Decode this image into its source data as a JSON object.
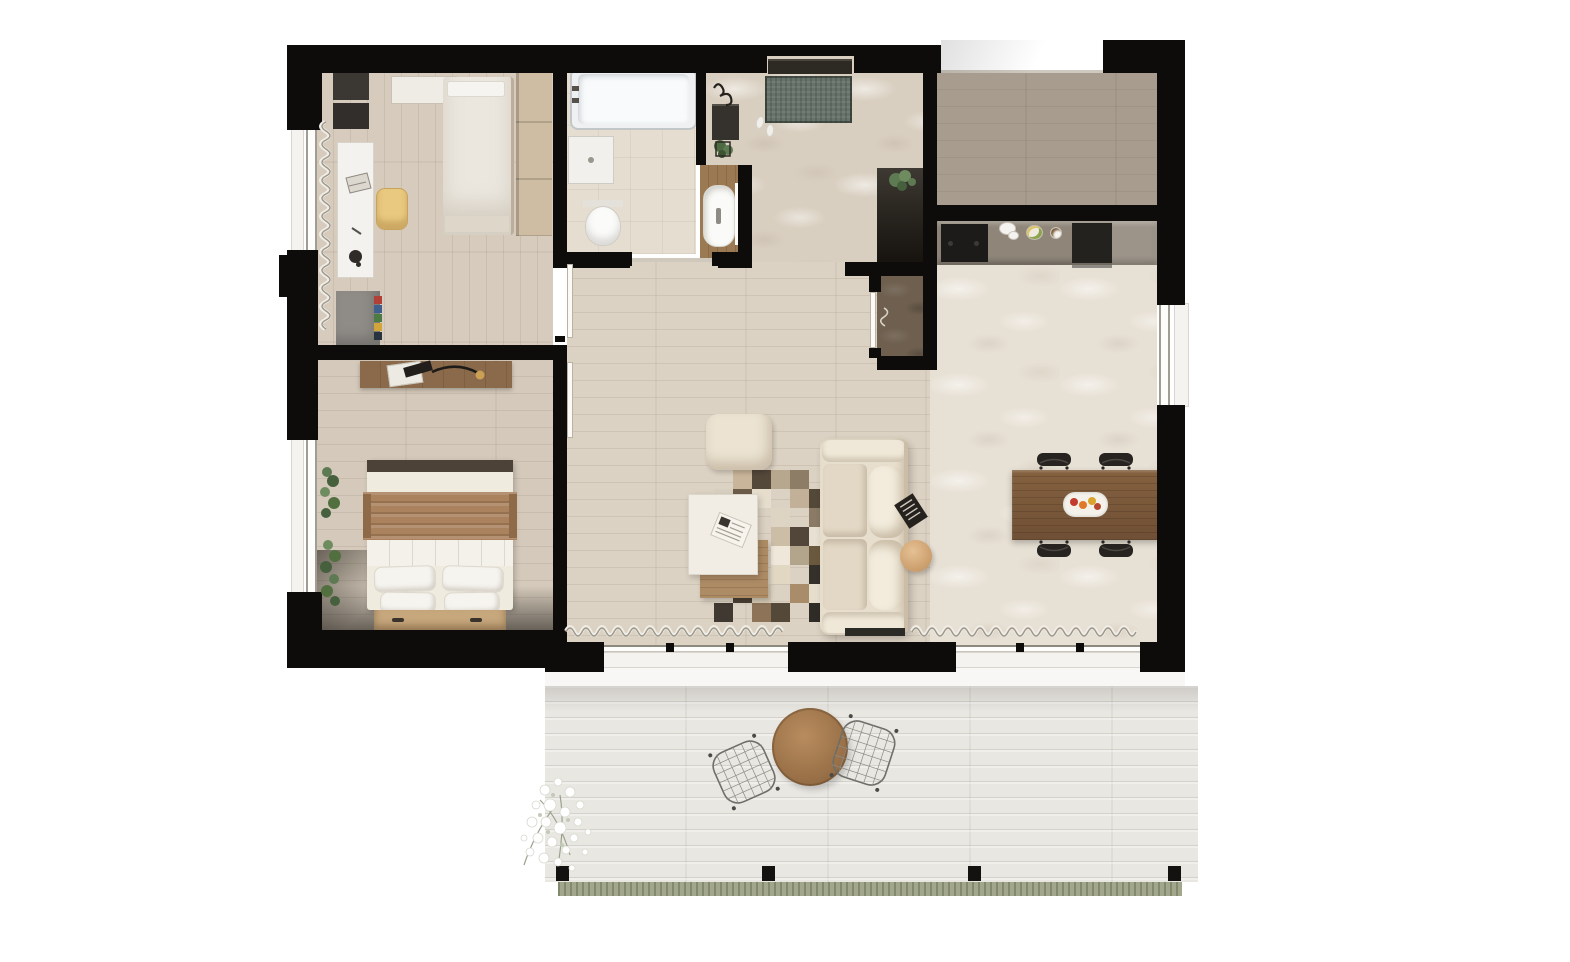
{
  "meta": {
    "title": "Apartment floor plan - photorealistic top-down render",
    "view": "top-down",
    "visible_text": "none (render contains no labels or dimensions)"
  },
  "palette": {
    "background": "#ffffff",
    "wall_black": "#0d0c0a",
    "office_floor": "#d6cbbc",
    "bedroom_floor": "#d4c9ba",
    "bathroom_floor": "#e5ded0",
    "hall_rug_beige": "#d9cfc0",
    "back_room_floor": "#a79c8e",
    "kitchen_counter": "#8f8679",
    "appliance_dark": "#1d1b19",
    "tall_cabinet_dark": "#2a2620",
    "living_floor": "#dcd2c3",
    "dining_rug_cream": "#e7e0d4",
    "sofa_cream": "#e7decd",
    "dining_table_wood": "#7e5c3f",
    "coffee_table_white": "#f2ede4",
    "coffee_table_shelf_wood": "#ad8b65",
    "terrace_deck": "#e9e7e2",
    "terrace_table_wood": "#a0764c",
    "doormat_green": "#67736a",
    "plant_green": "#5e7a52",
    "grass_green": "#a2a68c",
    "bed_throw_brown": "#aa825e",
    "desk_chair_yellow": "#e9c87f",
    "book_colors": [
      "#b04038",
      "#3f5f8f",
      "#4d7b45",
      "#d2a53b",
      "#27333f"
    ]
  },
  "rooms": [
    {
      "id": "office",
      "label": "Office / guest bedroom",
      "furniture": [
        "single bed",
        "wardrobe",
        "white desk",
        "yellow desk chair",
        "desk lamp",
        "laptop",
        "storage boxes",
        "wall tray shelf",
        "grey side table with colored books",
        "window curtain"
      ]
    },
    {
      "id": "bathroom",
      "label": "Bathroom",
      "furniture": [
        "bathtub with faucet",
        "shower tray",
        "wall-hung toilet",
        "wooden vanity with white basin"
      ]
    },
    {
      "id": "hall",
      "label": "Entry hall",
      "furniture": [
        "entry door",
        "green doormat",
        "slippers",
        "coat hooks",
        "dark console",
        "potted plant",
        "beige textured rug"
      ]
    },
    {
      "id": "backroom",
      "label": "Back room",
      "furniture": [
        "empty - dark wood plank floor"
      ]
    },
    {
      "id": "kitchen",
      "label": "Kitchen",
      "furniture": [
        "counter",
        "cooktop",
        "double sink",
        "fruit bowl",
        "coffee cup",
        "built-in oven",
        "tall dark cabinet with plant"
      ]
    },
    {
      "id": "closet",
      "label": "Storage closet",
      "furniture": [
        "door with handle",
        "stone floor"
      ]
    },
    {
      "id": "living",
      "label": "Living room",
      "furniture": [
        "cream sofa with back cushions",
        "book",
        "pouf",
        "white coffee table",
        "wood under-shelf",
        "magazine",
        "patchwork rug",
        "round side table",
        "sliding glass wall with curtains"
      ]
    },
    {
      "id": "dining",
      "label": "Dining area",
      "furniture": [
        "rectangular wood dining table",
        "four black chairs",
        "fruit platter",
        "cream sculpted carpet",
        "window"
      ]
    },
    {
      "id": "bedroom",
      "label": "Bedroom",
      "furniture": [
        "double bed",
        "brown throw",
        "white blanket",
        "four pillows",
        "bench dresser with handles",
        "wall shelf",
        "arc reading lamp",
        "green plants at window"
      ]
    },
    {
      "id": "terrace",
      "label": "Terrace",
      "furniture": [
        "whitewashed decking",
        "round wooden bistro table",
        "two wireframe chairs",
        "white flowering shrub",
        "four fence posts",
        "grass edge"
      ]
    }
  ]
}
